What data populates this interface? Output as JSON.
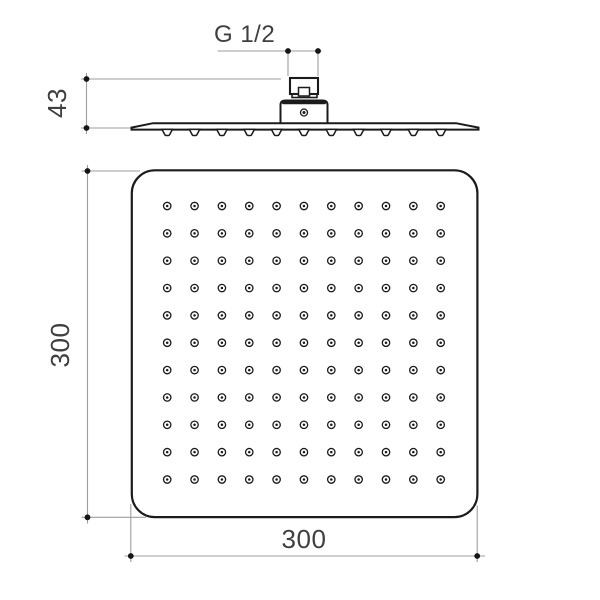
{
  "drawing": {
    "labels": {
      "thread_size": "G 1/2",
      "side_height_mm": "43",
      "front_height_mm": "300",
      "front_width_mm": "300"
    },
    "views": {
      "side_view": {
        "nozzle_count": 11
      },
      "front_view": {
        "nozzle_grid": {
          "rows": 11,
          "cols": 11
        }
      }
    },
    "colors": {
      "background": "#ffffff",
      "drawing_line": "#1b1b1b",
      "dimension_line": "#9e9e9e",
      "dimension_text": "#3f3f3f"
    }
  }
}
